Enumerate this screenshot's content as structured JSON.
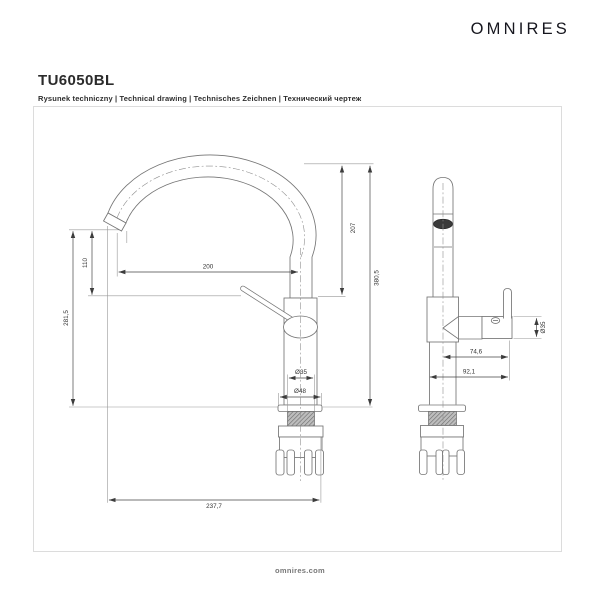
{
  "header": {
    "logo_text": "OMNIRES",
    "product_code": "TU6050BL",
    "subtitle": "Rysunek techniczny | Technical drawing | Technisches Zeichnen | Технический чертеж"
  },
  "drawing": {
    "front_view": {
      "dimensions": [
        {
          "id": "spout-outlet-drop",
          "value": "110"
        },
        {
          "id": "spout-outlet-height",
          "value": "281,5"
        },
        {
          "id": "spout-reach",
          "value": "200"
        },
        {
          "id": "arc-clearance",
          "value": "207"
        },
        {
          "id": "total-height",
          "value": "380,5"
        },
        {
          "id": "body-diameter",
          "value": "Ø35"
        },
        {
          "id": "base-diameter",
          "value": "Ø48"
        },
        {
          "id": "overall-reach",
          "value": "237,7"
        }
      ]
    },
    "side_view": {
      "dimensions": [
        {
          "id": "handle-diameter",
          "value": "Ø35"
        },
        {
          "id": "handle-offset",
          "value": "74,6"
        },
        {
          "id": "overall-depth",
          "value": "92,1"
        }
      ]
    }
  },
  "footer": {
    "website": "omnires.com"
  },
  "colors": {
    "outline": "#757575",
    "dimension_line": "#454545",
    "label_text": "#333333",
    "frame_border": "#dcdcdc",
    "aerator_fill": "#3a3a3a",
    "thread_hatch": "#6b6b6b"
  }
}
